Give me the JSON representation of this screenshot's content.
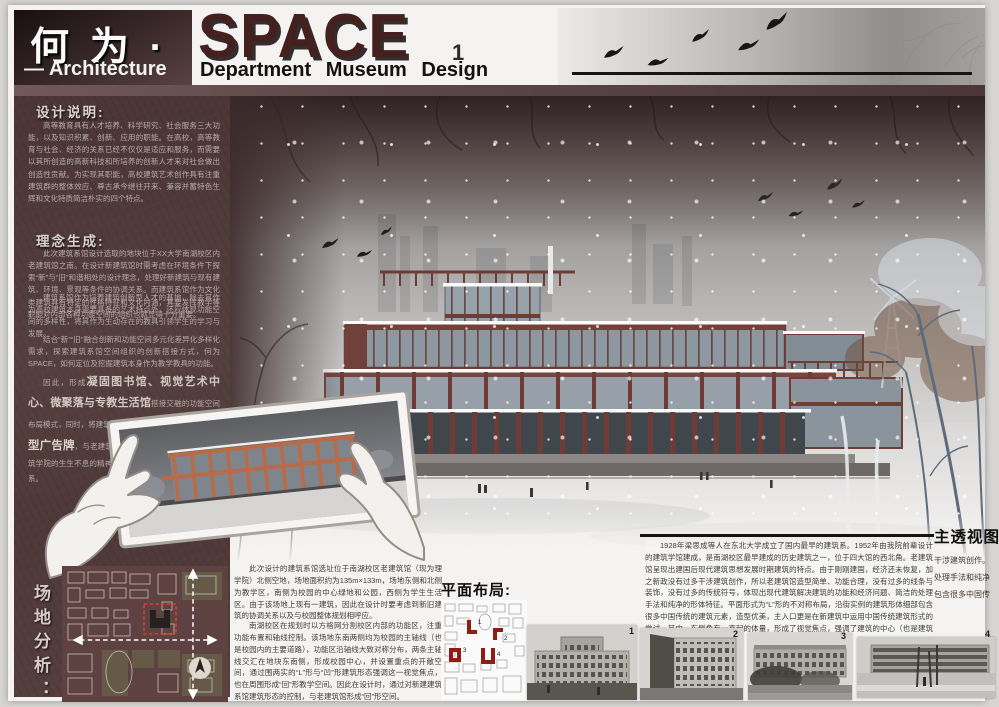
{
  "header": {
    "title_cn": "何 为 ·",
    "title_en": "SPACE",
    "page_number": "1",
    "subtitle_left": "— Architecture",
    "subtitle_right": "Department Museum Design"
  },
  "colors": {
    "maroon_dark": "#352526",
    "maroon_panel": "#503b3a",
    "accent_red_frame": "#6e3c35",
    "site_red": "#e23b30",
    "paper": "#f4f3f1"
  },
  "design_note": {
    "heading": "设计说明:",
    "p1": "高等教育具有人才培养、科学研究、社会服务三大功能，以及知识积累、创新、应用的职能。在高校，高等教育与社会、经济的关系已经不仅仅是适应和服务，而需要以其所创造的高新科技和所培养的创新人才来对社会做出创造性贡献。为实现其职能，高校建筑艺术创作具有注重建筑群的整体效应、尊古承今继往开来、兼容并蓄特色生辉和文化特质简洁朴实的四个特点。",
    "p2": "建筑系馆作为培养建筑创新型人才的基地，除去其作为高校建筑本身需要具备的艺术特点外，还应体现功能空间的多样性，将其作为生动存在的教具引领学生的学习与发展。"
  },
  "concept": {
    "heading": "理念生成:",
    "p1": "此次建筑系馆设计选取的地块位于ΧΧ大学南湖校区内老建筑馆之南。在设计新建筑馆时需考虑在环境条件下探索“新”与“旧”和谐相处的设计理念，处理好新建筑与现有建筑、环境、景观等条件的协调关系。而建筑系馆作为文化类建筑具有特定的性格特征和文化内涵，其要发挥教学等职能对内部各种功能空间的组织也就显得十分重要。",
    "p2": "结合“新”“旧”融合创新和功能空间多元化差异化多样化需求，探索建筑系馆空间组织的创新搭接方式，何为SPACE，如何定位及挖掘建筑本身作为教学教具的功能。",
    "p3_lead": "因此，形成",
    "p3_em1": "凝固图书馆、视觉艺术中心、微聚落与专教生活馆",
    "p3_mid": "搭接交融的功能空间布局模式，同时，将建筑馆沿街之区域作为向外展示的",
    "p3_em2": "巨型广告牌",
    "p3_tail": "，与老建筑馆相呼应，展示建筑无止境、建筑学院的生生不息的精神，加强建筑与功能、与环境的联系。"
  },
  "site": {
    "heading": "场地分析："
  },
  "render": {
    "label": "主透视图",
    "notes": [
      "干涉建筑创作。",
      "处理手法和纯净",
      "包含很多中国传"
    ]
  },
  "bottom": {
    "left_p1": "此次设计的建筑系馆选址位于南湖校区老建筑馆（现为理学院）北侧空地，场地面积约为135m×133m，场地东侧和北侧为教学区，南侧为校园的中心绿地和公园，西侧为学生生活区。由于该场地上现有一建筑，因此在设计时要考虑到新旧建筑的协调关系以及与校园整体规划相呼应。",
    "left_p2": "南湖校区在规划时以方格网分割校区内部的功能区，注重功能布置和轴线控制。该场地东南两侧均为校园的主轴线（也是校园内的主要道路），功能区沿轴线大致对称分布，两条主轴线交汇在地块东南侧，形成校园中心，并设置重点的开敞空间，通过围两实的“L”形与“凹”形建筑形态强调这一视觉焦点，也在周围形成“回”形教学空间。因此在设计时，通过对新建建筑系馆建筑形态的控制，与老建筑馆形成“回”形空间。",
    "history": "1928年梁思成等人在东北大学成立了国内最早的建筑系。1952年由我院前辈设计的建筑学馆建成，是南湖校区最早建成的历史建筑之一，位于四大馆的西北角。老建筑馆呈现出建国后现代建筑思想发展时期建筑的特点。由于刚刚建国，经济还未恢复，加之新政没有过多干涉建筑创作，所以老建筑馆造型简单、功能合理，没有过多的线条与装饰，没有过多的传统符号，体现出现代建筑解决建筑的功能和经济问题、简洁的处理手法和纯净的形体特征。平面形式为“L”形的不对称布局，沿街实例的建筑形体细部包含很多中国传统的建筑元素，造型优美，主入口更是在新建筑中运用中国传统建筑形式的尝试。其中，东侧角有一高起的体量，形成了视觉焦点，强调了建筑的中心（也是建筑的入口）。",
    "plan_heading": "平面布局:",
    "plan_numbers": [
      "1",
      "2",
      "3",
      "4"
    ],
    "photo_labels": [
      "1",
      "2",
      "3",
      "4"
    ]
  }
}
